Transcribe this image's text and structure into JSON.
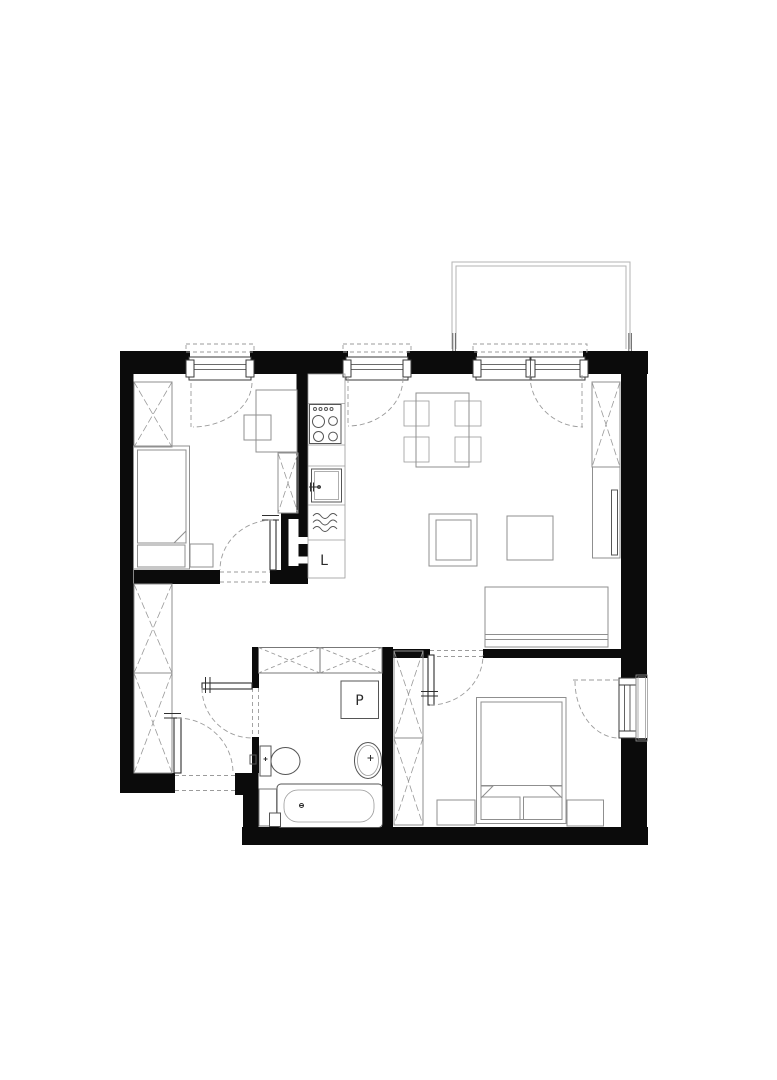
{
  "document": {
    "kind": "architectural floor plan",
    "background": "#ffffff"
  },
  "palette": {
    "wall": "#0b0b0b",
    "furniture_line": "#8f8f8f",
    "fixture_line": "#555555",
    "window_line": "#3a3a3a",
    "swing_line": "#9b9b9b",
    "balcony_line": "#b3b3b3",
    "label_text": "#2b2b2b"
  },
  "labels": {
    "fridge": "L",
    "washing_machine": "P"
  },
  "icons": [
    "balcony",
    "window",
    "balcony-door",
    "single-bed",
    "double-bed",
    "wardrobe",
    "desk",
    "chair",
    "dining-table",
    "dining-chair",
    "coffee-table",
    "side-table",
    "sofa",
    "tv-cabinet",
    "kitchen-counter",
    "stove",
    "kitchen-sink",
    "dishwasher",
    "fridge",
    "washing-machine",
    "toilet",
    "washbasin",
    "bathtub",
    "duct-niche",
    "overhead-storage",
    "door-swing",
    "entrance-door",
    "window-swing",
    "nightstand"
  ]
}
